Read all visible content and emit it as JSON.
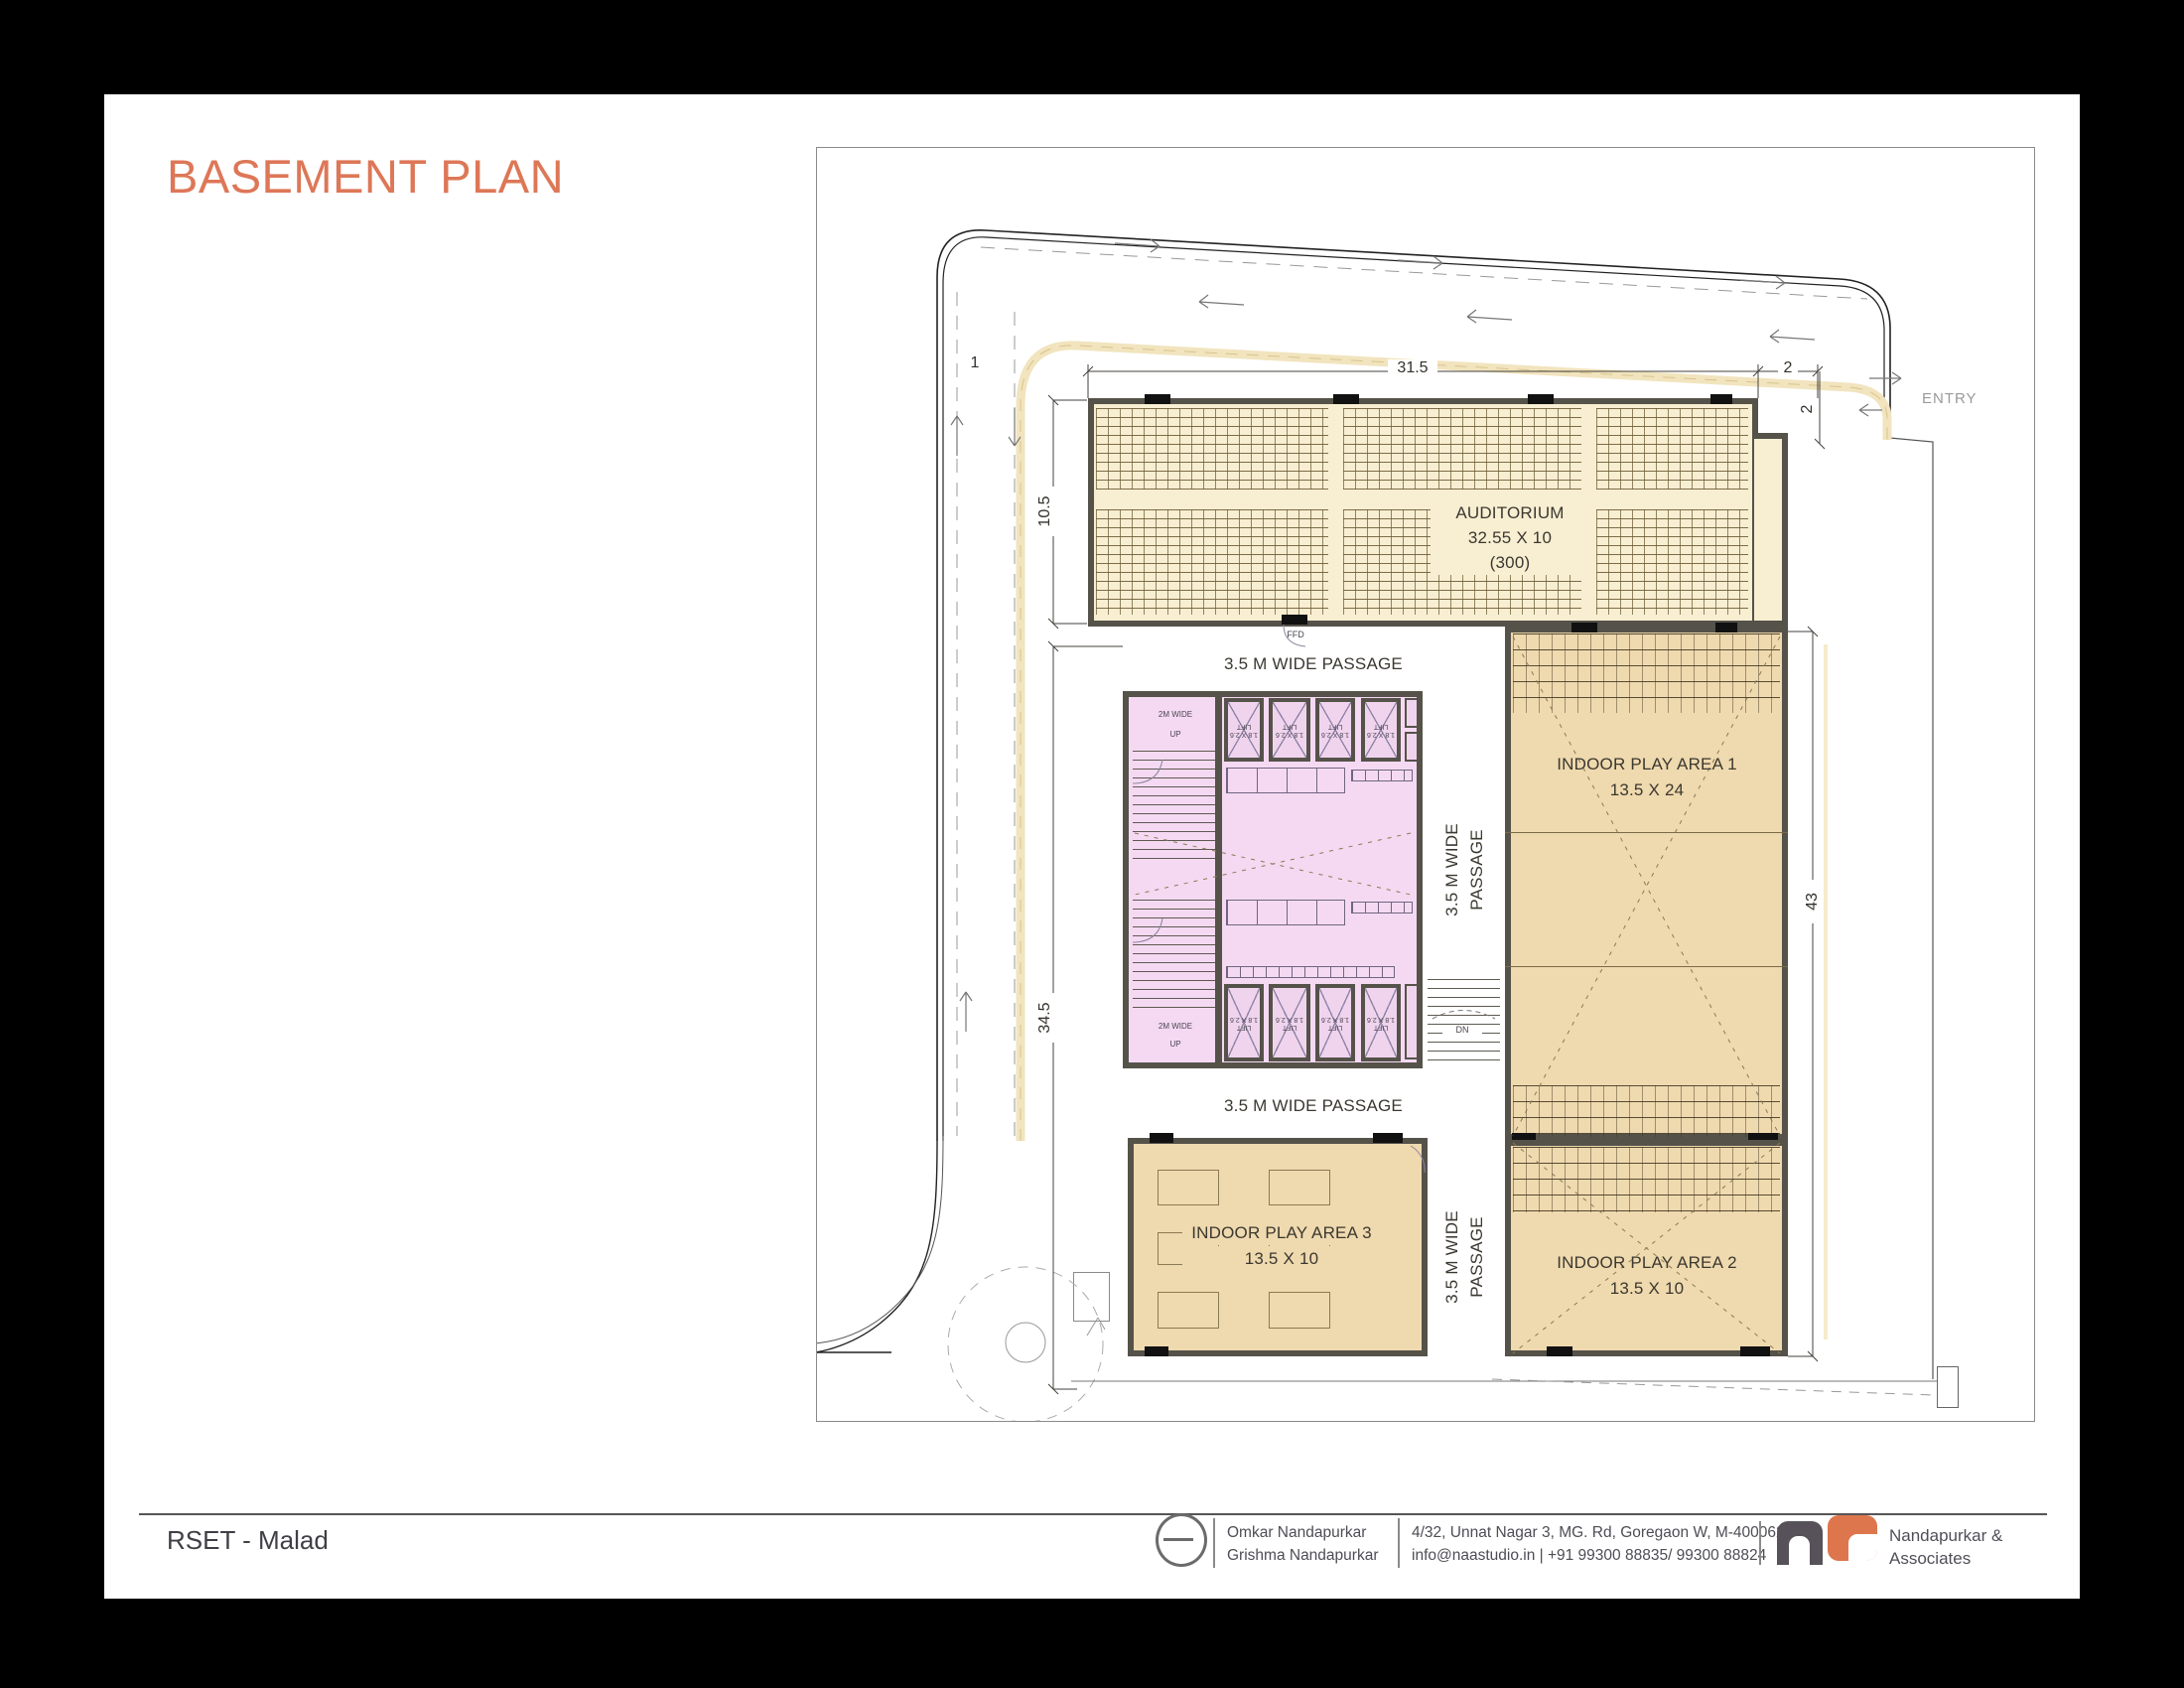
{
  "title": "BASEMENT PLAN",
  "colors": {
    "accent": "#DD7757",
    "auditorium_fill": "#F8EED2",
    "play_fill": "#EFD9AE",
    "core_fill": "#F5D9F2",
    "wall": "#55524A",
    "logo_orange": "#DE764D",
    "logo_gray": "#57525A"
  },
  "plan": {
    "auditorium": {
      "name": "AUDITORIUM",
      "size": "32.55 X 10",
      "capacity": "(300)",
      "door": "FFD"
    },
    "passages": {
      "top": "3.5 M WIDE PASSAGE",
      "bottom": "3.5 M WIDE PASSAGE",
      "vertical_upper": "3.5 M WIDE PASSAGE",
      "vertical_lower": "3.5 M WIDE PASSAGE"
    },
    "play_area_1": {
      "name": "INDOOR PLAY AREA 1",
      "size": "13.5 X 24"
    },
    "play_area_2": {
      "name": "INDOOR PLAY AREA 2",
      "size": "13.5 X 10"
    },
    "play_area_3": {
      "name": "INDOOR PLAY AREA 3",
      "size": "13.5 X 10"
    },
    "stairs": {
      "width_label": "2M WIDE",
      "up": "UP",
      "down": "DN"
    },
    "lift": {
      "label": "LIFT",
      "size": "1.8 X 2.6"
    },
    "dimensions": {
      "top_width": "31.5",
      "top_offset": "2",
      "entry_width": "2",
      "auditorium_depth": "10.5",
      "left_height": "34.5",
      "right_height": "43",
      "left_top": "1"
    },
    "entry_label": "ENTRY"
  },
  "footer": {
    "project": "RSET - Malad",
    "architects": [
      "Omkar Nandapurkar",
      "Grishma Nandapurkar"
    ],
    "address_line1": "4/32, Unnat Nagar 3, MG. Rd, Goregaon W, M-400062",
    "address_line2": "info@naastudio.in  | +91 99300 88835/ 99300 88824",
    "brand_line1": "Nandapurkar  &",
    "brand_line2": "Associates"
  }
}
